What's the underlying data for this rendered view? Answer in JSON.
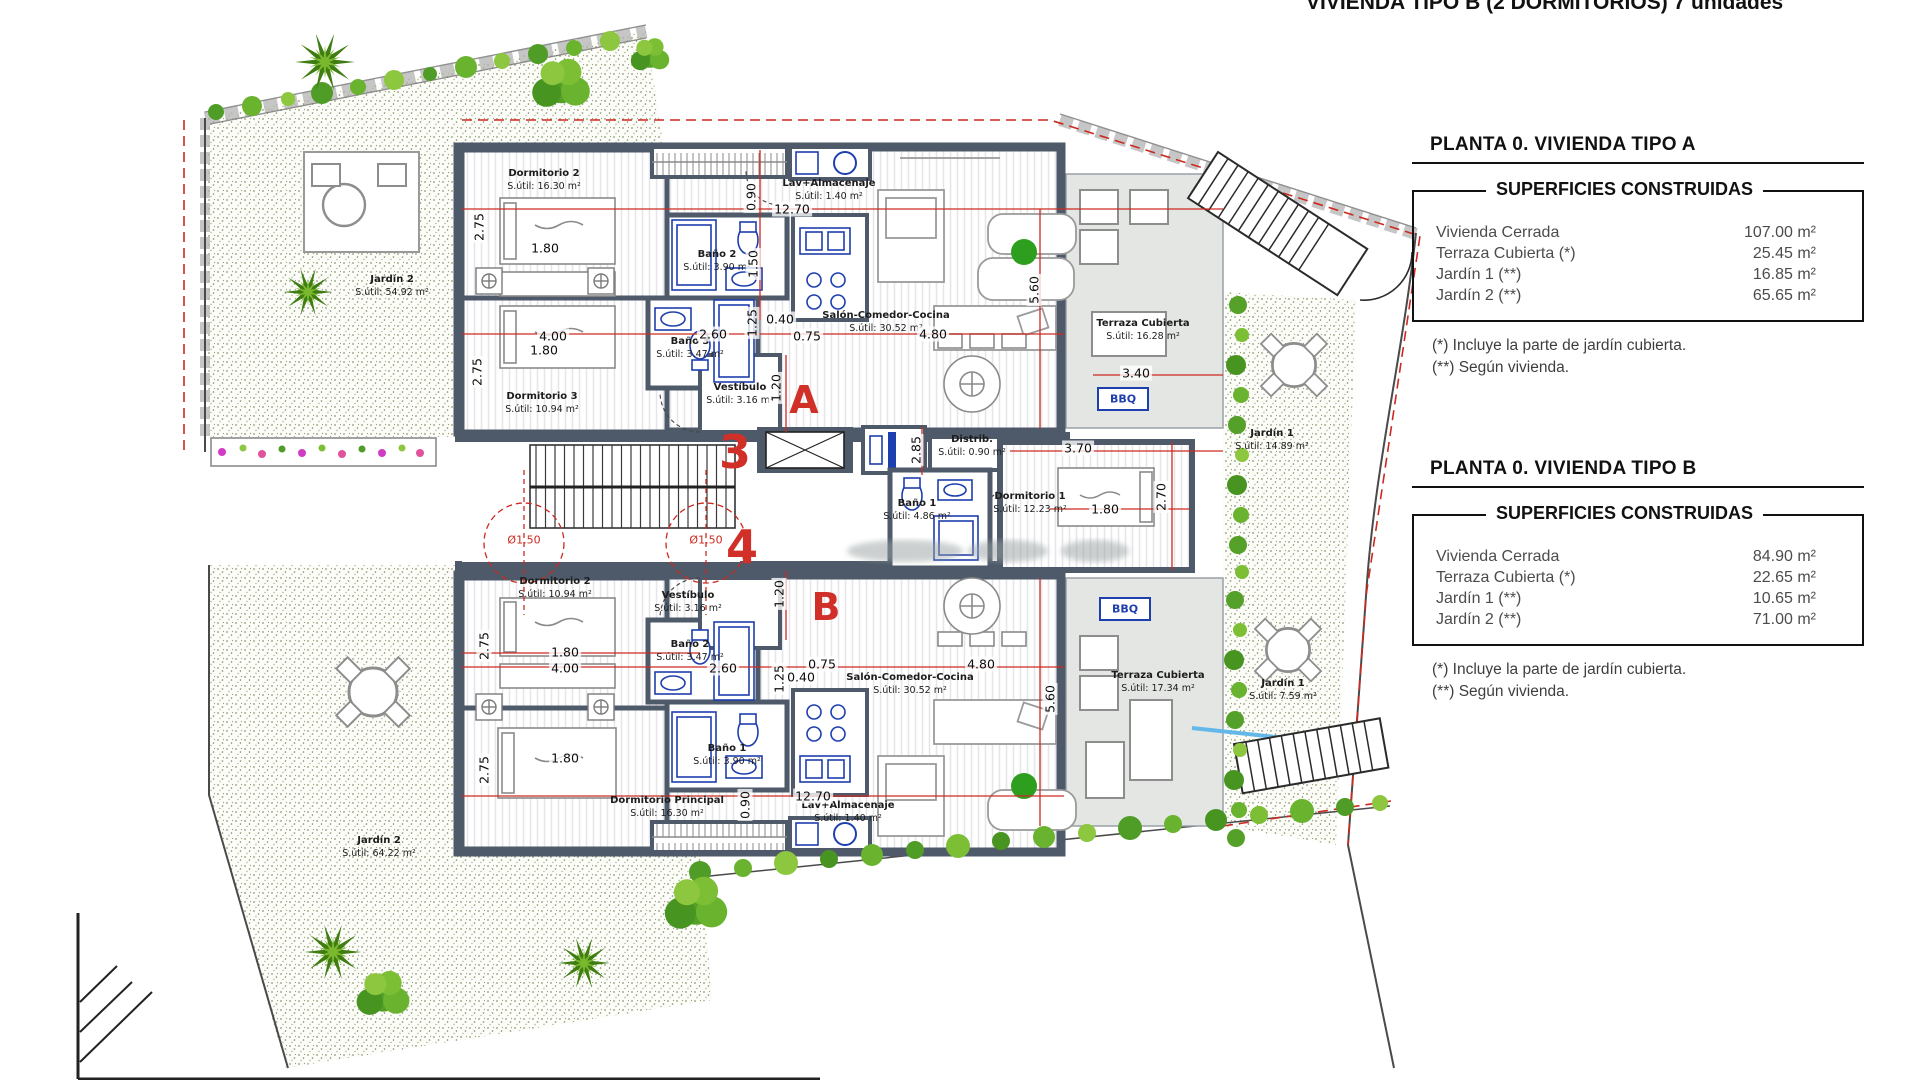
{
  "header": {
    "title": "VIVIENDA TIPO B (2 DORMITORIOS) 7 unidades"
  },
  "tables": {
    "tipo_a": {
      "title": "PLANTA 0. VIVIENDA TIPO A",
      "subtitle": "SUPERFICIES CONSTRUIDAS",
      "rows": [
        {
          "label": "Vivienda Cerrada",
          "value": "107.00 m²"
        },
        {
          "label": "Terraza Cubierta  (*)",
          "value": "25.45 m²"
        },
        {
          "label": "Jardín 1 (**)",
          "value": "16.85 m²"
        },
        {
          "label": "Jardín 2 (**)",
          "value": "65.65 m²"
        }
      ],
      "notes": [
        "(*)  Incluye la parte de jardín cubierta.",
        "(**) Según vivienda."
      ]
    },
    "tipo_b": {
      "title": "PLANTA 0. VIVIENDA TIPO B",
      "subtitle": "SUPERFICIES CONSTRUIDAS",
      "rows": [
        {
          "label": "Vivienda Cerrada",
          "value": "84.90 m²"
        },
        {
          "label": "Terraza Cubierta (*)",
          "value": "22.65 m²"
        },
        {
          "label": "Jardín 1 (**)",
          "value": "10.65 m²"
        },
        {
          "label": "Jardín 2 (**)",
          "value": "71.00 m²"
        }
      ],
      "notes": [
        "(*) Incluye la parte de jardín cubierta.",
        "(**) Según vivienda."
      ]
    }
  },
  "plan": {
    "unit_a": {
      "letter": "A",
      "portal": "3",
      "bbq": "BBQ",
      "rooms": {
        "dormitorio2": {
          "name": "Dormitorio 2",
          "area": "S.útil: 16.30 m²"
        },
        "dormitorio3": {
          "name": "Dormitorio 3",
          "area": "S.útil: 10.94 m²"
        },
        "bano2": {
          "name": "Baño 2",
          "area": "S.útil: 3.90 m²"
        },
        "bano3": {
          "name": "Baño 3",
          "area": "S.útil: 3.47 m²"
        },
        "vestibulo": {
          "name": "Vestíbulo",
          "area": "S.útil: 3.16 m²"
        },
        "lav": {
          "name": "Lav+Almacenaje",
          "area": "S.útil: 1.40 m²"
        },
        "salon": {
          "name": "Salón-Comedor-Cocina",
          "area": "S.útil: 30.52 m²"
        },
        "distrib": {
          "name": "Distrib.",
          "area": "S.útil: 0.90 m²"
        },
        "dormitorio1": {
          "name": "Dormitorio 1",
          "area": "S.útil: 12.23 m²"
        },
        "bano1": {
          "name": "Baño 1",
          "area": "S.útil: 4.86 m²"
        },
        "terraza": {
          "name": "Terraza Cubierta",
          "area": "S.útil: 16.28 m²"
        },
        "jardin1": {
          "name": "Jardín 1",
          "area": "S.útil: 14.89 m²"
        },
        "jardin2": {
          "name": "Jardín 2",
          "area": "S.útil: 54.92 m²"
        }
      }
    },
    "unit_b": {
      "letter": "B",
      "portal": "4",
      "bbq": "BBQ",
      "rooms": {
        "dormitorio2": {
          "name": "Dormitorio 2",
          "area": "S.útil: 10.94 m²"
        },
        "dormitorio_principal": {
          "name": "Dormitorio Principal",
          "area": "S.útil: 16.30 m²"
        },
        "bano2": {
          "name": "Baño 2",
          "area": "S.útil: 3.47 m²"
        },
        "bano1": {
          "name": "Baño 1",
          "area": "S.útil: 3.90 m²"
        },
        "vestibulo": {
          "name": "Vestíbulo",
          "area": "S.útil: 3.16 m²"
        },
        "lav": {
          "name": "Lav+Almacenaje",
          "area": "S.útil: 1.40 m²"
        },
        "salon": {
          "name": "Salón-Comedor-Cocina",
          "area": "S.útil: 30.52 m²"
        },
        "terraza": {
          "name": "Terraza Cubierta",
          "area": "S.útil: 17.34 m²"
        },
        "jardin1": {
          "name": "Jardín 1",
          "area": "S.útil: 7.59 m²"
        },
        "jardin2": {
          "name": "Jardín 2",
          "area": "S.útil: 64.22 m²"
        }
      }
    },
    "dims": {
      "a": [
        "2.75",
        "1.80",
        "4.00",
        "1.80",
        "2.75",
        "2.60",
        "1.25",
        "0.40",
        "0.75",
        "12.70",
        "0.90",
        "1.50",
        "4.80",
        "5.60",
        "3.40",
        "2.85",
        "3.70",
        "1.80",
        "2.70",
        "1.20"
      ],
      "b": [
        "2.75",
        "1.80",
        "4.00",
        "2.60",
        "1.25",
        "0.40",
        "0.75",
        "4.80",
        "1.20",
        "2.75",
        "1.80",
        "12.70",
        "0.90",
        "5.60"
      ],
      "circles": [
        "Ø1.50",
        "Ø1.50"
      ]
    },
    "colors": {
      "wall": "#4e5a6a",
      "dim_red": "#cc2a20",
      "terrace_grey": "#e4e6e3",
      "garden_green": "#5ea32c",
      "fixture_blue": "#1e3fae"
    }
  }
}
